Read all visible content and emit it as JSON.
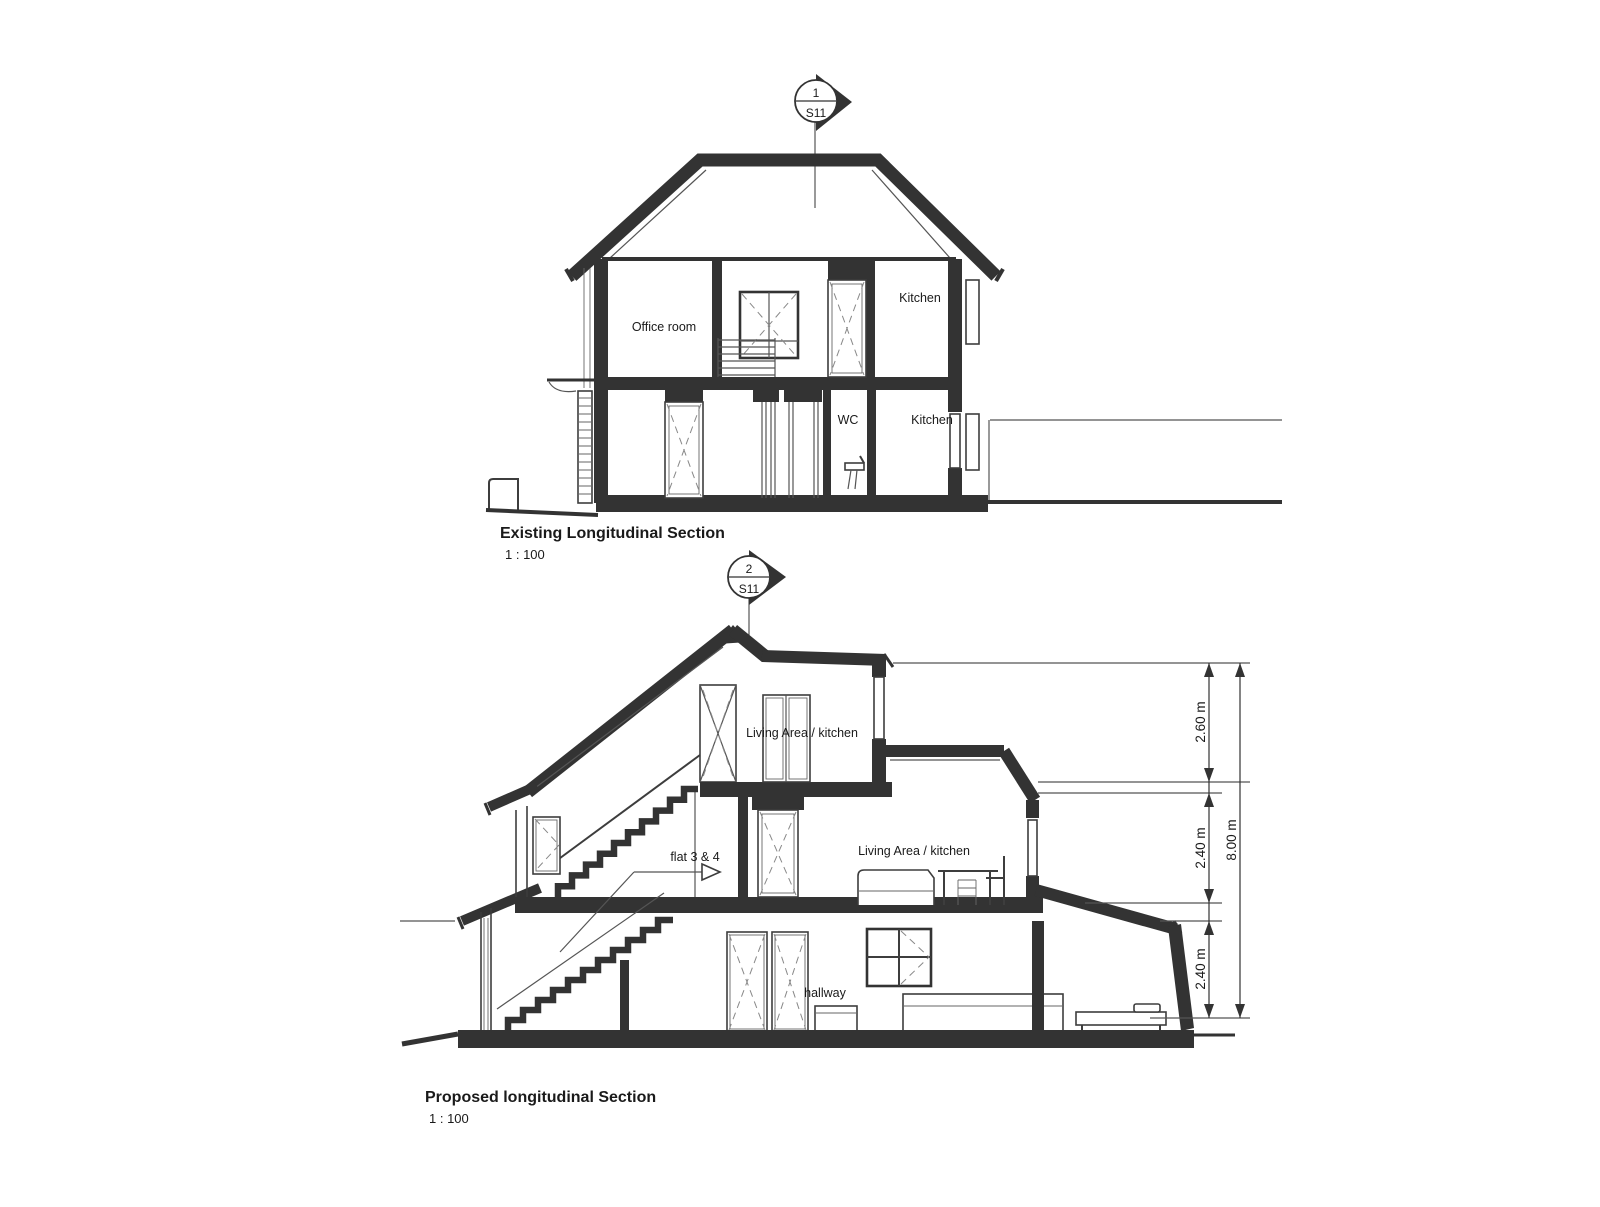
{
  "page": {
    "background": "#ffffff",
    "ink": "#333333"
  },
  "existing_section": {
    "marker": {
      "number": "1",
      "sheet": "S11"
    },
    "labels": {
      "office_room": "Office room",
      "kitchen_upper": "Kitchen",
      "wc": "WC",
      "kitchen_lower": "Kitchen"
    },
    "title": "Existing Longitudinal Section",
    "scale": "1 : 100"
  },
  "proposed_section": {
    "marker": {
      "number": "2",
      "sheet": "S11"
    },
    "labels": {
      "living_top": "Living Area / kitchen",
      "flats": "flat 3 & 4",
      "living_mid": "Living Area / kitchen",
      "hallway": "hallway"
    },
    "dimensions": {
      "top_floor": "2.60 m",
      "mid_floor": "2.40 m",
      "ground_floor": "2.40 m",
      "overall": "8.00 m"
    },
    "title": "Proposed longitudinal Section",
    "scale": "1 : 100"
  }
}
